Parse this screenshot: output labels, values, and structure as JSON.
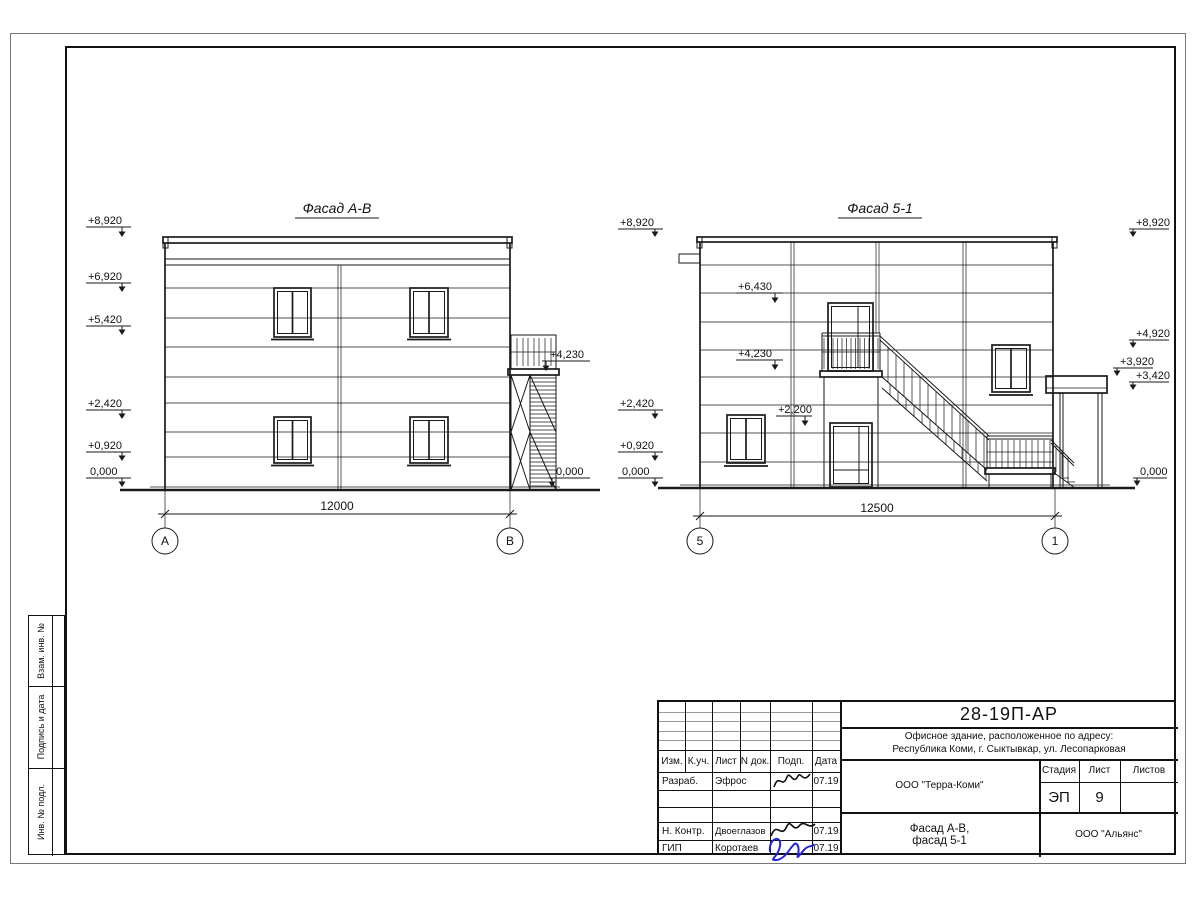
{
  "facade_ab": {
    "title": "Фасад А-В",
    "dim": "12000",
    "axis_left": "А",
    "axis_right": "В",
    "marks_left": [
      "+8,920",
      "+6,920",
      "+5,420",
      "+2,420",
      "+0,920",
      "0,000"
    ],
    "marks_right": [
      "+4,230",
      "0,000"
    ]
  },
  "facade_51": {
    "title": "Фасад 5-1",
    "dim": "12500",
    "axis_left": "5",
    "axis_right": "1",
    "marks_left": [
      "+8,920",
      "+2,420",
      "+0,920",
      "0,000"
    ],
    "marks_inner": [
      "+6,430",
      "+4,230",
      "+2,200"
    ],
    "marks_right": [
      "+8,920",
      "+4,920",
      "+3,920",
      "+3,420",
      "0,000"
    ]
  },
  "title_block": {
    "code": "28-19П-АР",
    "object_line1": "Офисное здание, расположенное по адресу:",
    "object_line2": "Республика Коми, г. Сыктывкар, ул. Лесопарковая",
    "org": "ООО \"Терра-Коми\"",
    "doc_title_line1": "Фасад А-В,",
    "doc_title_line2": "фасад 5-1",
    "contractor": "ООО \"Альянс\"",
    "stage_label": "Стадия",
    "sheet_label": "Лист",
    "sheets_label": "Листов",
    "stage": "ЭП",
    "sheet_no": "9",
    "sheets_total": "",
    "cols": [
      "Изм.",
      "К.уч.",
      "Лист",
      "N док.",
      "Подп.",
      "Дата"
    ],
    "rows": [
      {
        "role": "Разраб.",
        "name": "Эфрос",
        "date": "07.19"
      },
      {
        "role": "Н. Контр.",
        "name": "Двоеглазов",
        "date": "07.19"
      },
      {
        "role": "ГИП",
        "name": "Коротаев",
        "date": "07.19"
      }
    ]
  },
  "side_labels": [
    "Взам. инв. №",
    "Подпись и дата",
    "Инв. № подл."
  ],
  "colors": {
    "signature_blue": "#2323dd",
    "line": "#1a1a1a"
  }
}
